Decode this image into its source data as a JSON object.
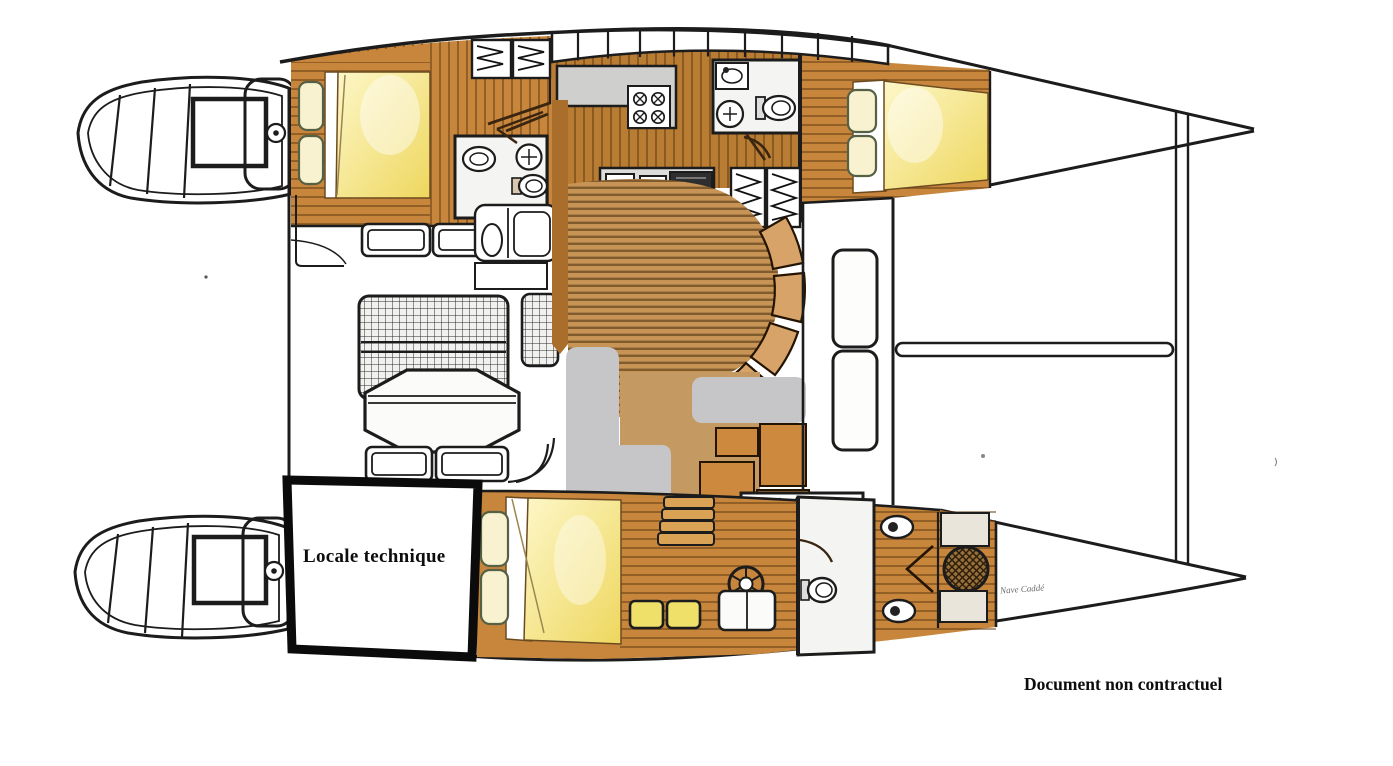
{
  "plan": {
    "technical_room_label": "Locale technique",
    "signature": "Nave Caddé",
    "disclaimer": "Document non contractuel"
  },
  "colors": {
    "background": "#ffffff",
    "outline": "#1c1c1c",
    "wood": "#c8863d",
    "wood_corridor": "#b97c33",
    "wood_stripe": "#8a5a28",
    "deck_tan": "#c89455",
    "seat_tan": "#d8a368",
    "cockpit_patch_tan": "#c59a62",
    "bed_yellow": "#eed75e",
    "bed_cream": "#f8f2d0",
    "patch_gray": "#c6c6c8",
    "counter_gray": "#cfcfcd",
    "window_yellow": "#efe06a",
    "technical_room_border": "#0b0b0b"
  }
}
